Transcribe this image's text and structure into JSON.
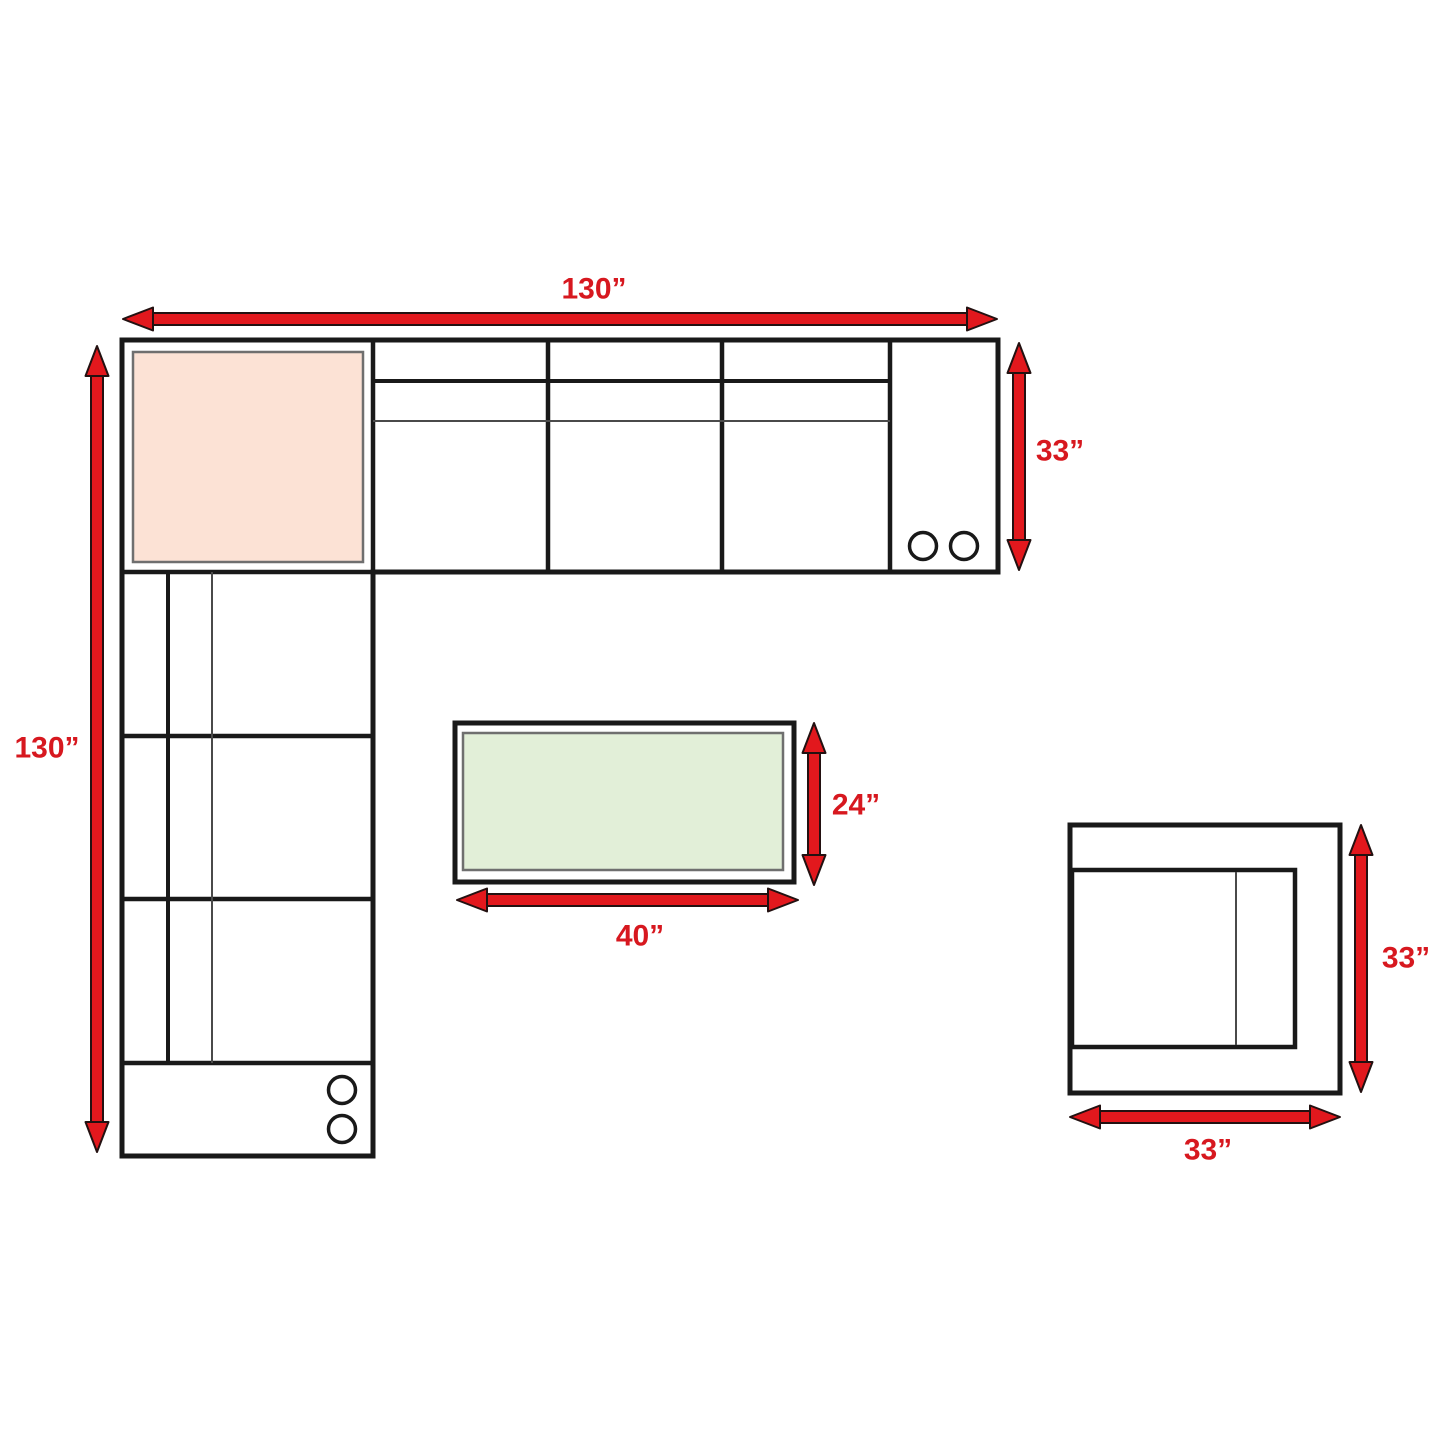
{
  "diagram": {
    "type": "sectional-sofa-dimension-floor-plan",
    "labels": {
      "sectional_width": "130”",
      "sectional_depth": "130”",
      "sectional_section_depth": "33”",
      "ottoman_depth": "24”",
      "ottoman_width": "40”",
      "chair_depth": "33”",
      "chair_width": "33”"
    },
    "colors": {
      "arrow_red": "#e2181d",
      "label_red": "#d7181f",
      "line_black": "#191919",
      "thin_line_gray": "#4a4a4a",
      "corner_cushion_fill": "#fce2d5",
      "ottoman_cushion_fill": "#e2efd8",
      "background": "#ffffff"
    }
  }
}
